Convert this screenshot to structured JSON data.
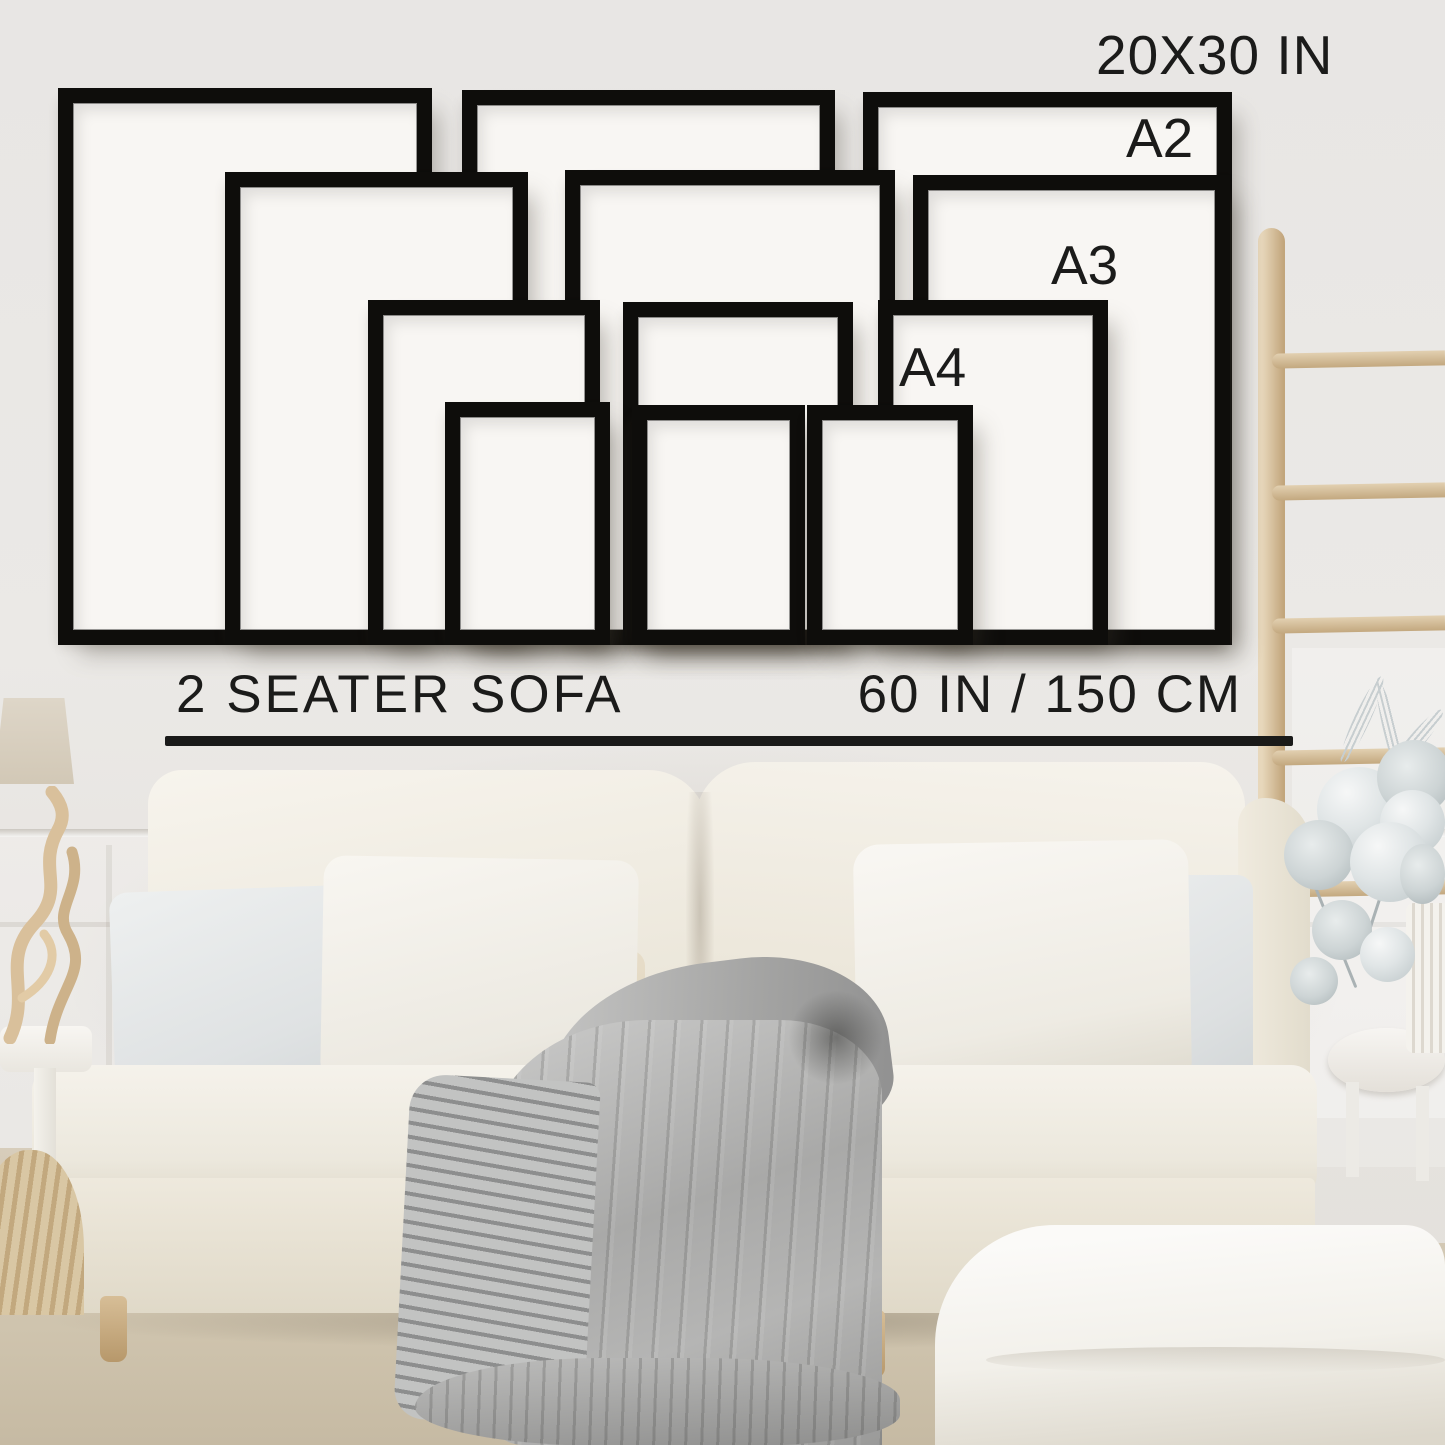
{
  "poster_sizes": {
    "top_label": "20X30 IN",
    "a2": "A2",
    "a3": "A3",
    "a4": "A4",
    "rows": [
      {
        "size": "20X30 IN",
        "frame_count": 3
      },
      {
        "size": "A2",
        "frame_count": 3
      },
      {
        "size": "A3",
        "frame_count": 3
      },
      {
        "size": "A4",
        "frame_count": 3
      }
    ]
  },
  "scale_reference": {
    "sofa_label": "2 SEATER SOFA",
    "sofa_width": "60 IN / 150 CM"
  },
  "colors": {
    "frame_black": "#0e0d0b",
    "text": "#1b1b1a",
    "wall": "#e9e7e4",
    "ladder_wood": "#d5bf9c",
    "sofa_cream": "#f1eee6",
    "blanket_gray": "#aeaeae",
    "floor_beige": "#cfc4ae"
  }
}
